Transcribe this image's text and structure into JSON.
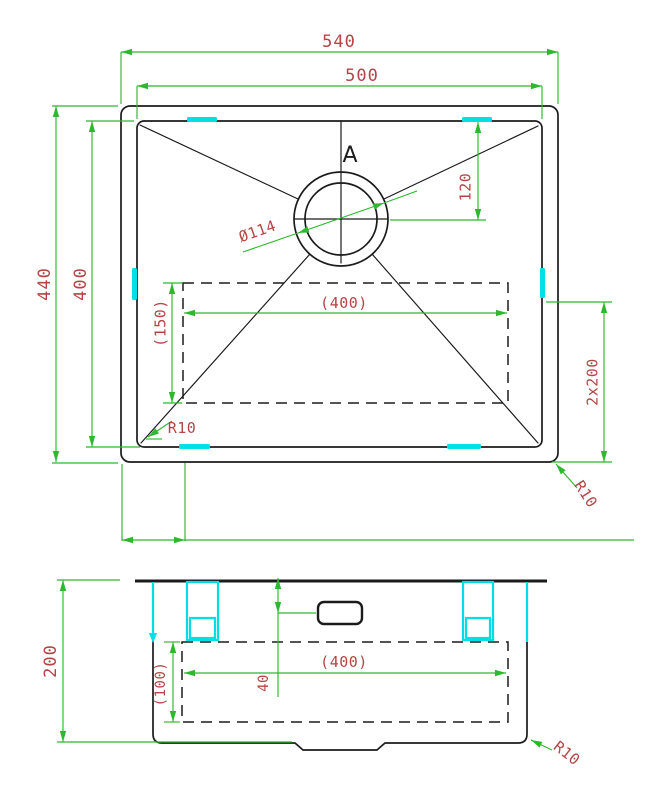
{
  "drawing": {
    "type": "sink-technical-drawing",
    "top_view": {
      "labels": {
        "width_overall": "540",
        "width_inner": "500",
        "depth_overall": "440",
        "depth_inner": "400",
        "drain_offset": "120",
        "drain_diameter": "Ø114",
        "recess_width": "(400)",
        "recess_depth": "(150)",
        "clip_spacing": "2x200",
        "corner_radius_inner": "R10",
        "corner_radius_outer": "R10",
        "section_marker": "A"
      }
    },
    "front_view": {
      "labels": {
        "height": "200",
        "recess_height": "(100)",
        "overflow_offset": "40",
        "recess_width": "(400)",
        "corner_radius": "R10"
      }
    },
    "colors": {
      "dimension_lines": "#2db82d",
      "dimension_text": "#b54545",
      "highlight": "#00dfe6",
      "outline": "#1b1b1b",
      "background": "#ffffff"
    }
  }
}
